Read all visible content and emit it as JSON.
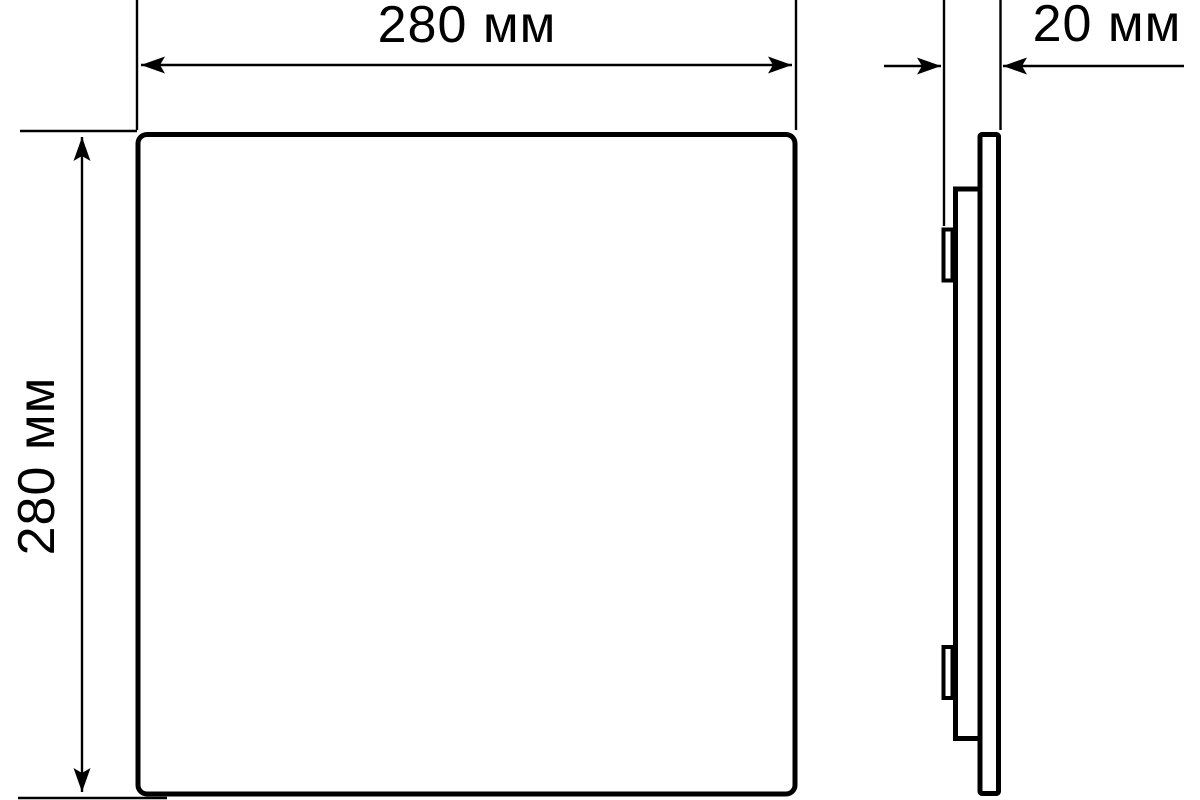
{
  "diagram": {
    "labels": {
      "width": "280 мм",
      "height": "280 мм",
      "depth": "20 мм"
    },
    "colors": {
      "line": "#000000",
      "background": "#ffffff",
      "panel_fill": "#ffffff"
    }
  }
}
